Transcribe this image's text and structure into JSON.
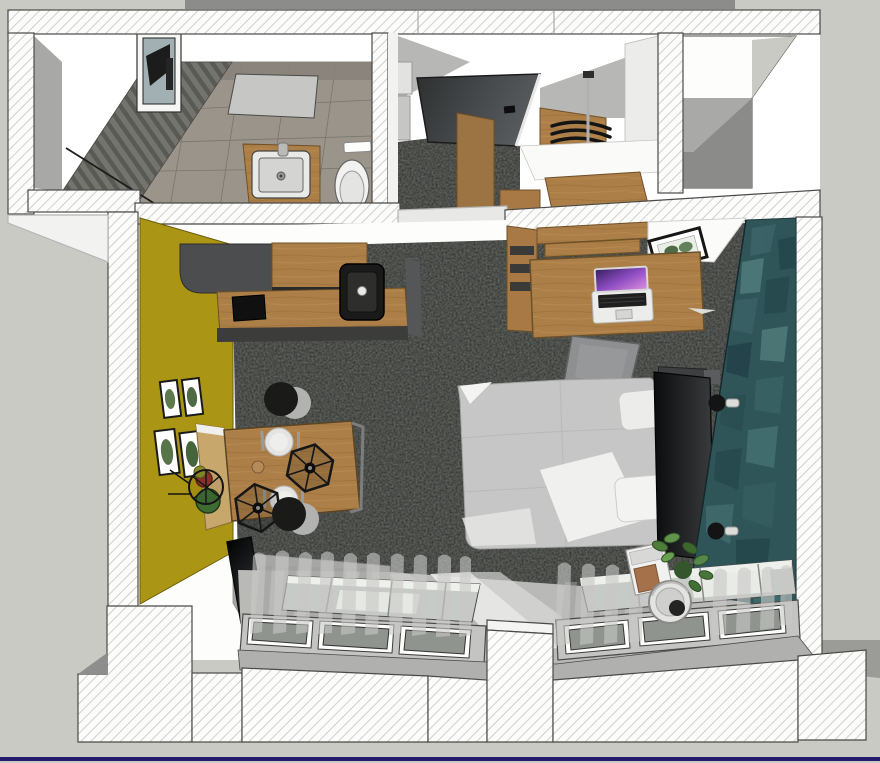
{
  "scene": {
    "title": "Studio apartment — top-down 3D interior render",
    "view": "plan view (roof removed), SketchUp-style hatched cut walls",
    "background_color": "#c9cac3",
    "viewport_edge_color": "#211a6e"
  },
  "palette": {
    "wall_hatch_line": "#c5c5c3",
    "wall_outline": "#4a4a48",
    "carpet_dark": "#2b2d2a",
    "wood": "#ad7f48",
    "wood_light": "#c8a76c",
    "yellow_wall": "#ab9514",
    "teal_wall": "#2f5559",
    "floor_light": "#b9b9b7",
    "window_glass": "#8f948f",
    "duvet": "#c6c6c6",
    "headboard": "#17181a",
    "entry_door": "#3a3c3e"
  },
  "rooms": {
    "bathroom": {
      "label": "Bathroom",
      "items": [
        "gray slat shower wall",
        "wood-look tile floor",
        "wood vanity with white sink",
        "toilet",
        "flush plate",
        "window"
      ]
    },
    "hall": {
      "label": "Entry hall",
      "items": [
        "dark entrance door",
        "dark carpet",
        "open wardrobe with black hangers",
        "coat-rack pole",
        "wood shelves"
      ]
    },
    "living_room": {
      "label": "Living room / studio",
      "items": [
        "kitchen counter with dark tall unit",
        "induction cooktop",
        "black corner sink",
        "dining table with bench",
        "two plates",
        "two wire pendant lamps",
        "two black stools",
        "wire basket with plant",
        "four botanical wall prints on yellow wall",
        "leaning TV",
        "double bed with white duvet and two pillows",
        "black headboard",
        "wood desk with laptop",
        "gray desk chair",
        "wood shelf unit",
        "framed print on white cabinet",
        "nightstand caddy with plant and round basket",
        "two black wall sconces on teal wall"
      ]
    },
    "exterior": {
      "label": "Exterior",
      "items": [
        "light-well recess at top right",
        "south window wall with two tilted windows",
        "sheer curtains"
      ]
    }
  },
  "counts": {
    "bottom_windows": 2,
    "stools": 2,
    "plates": 2,
    "pendant_lamps": 2,
    "wall_prints": 4,
    "wall_sconces": 2
  }
}
